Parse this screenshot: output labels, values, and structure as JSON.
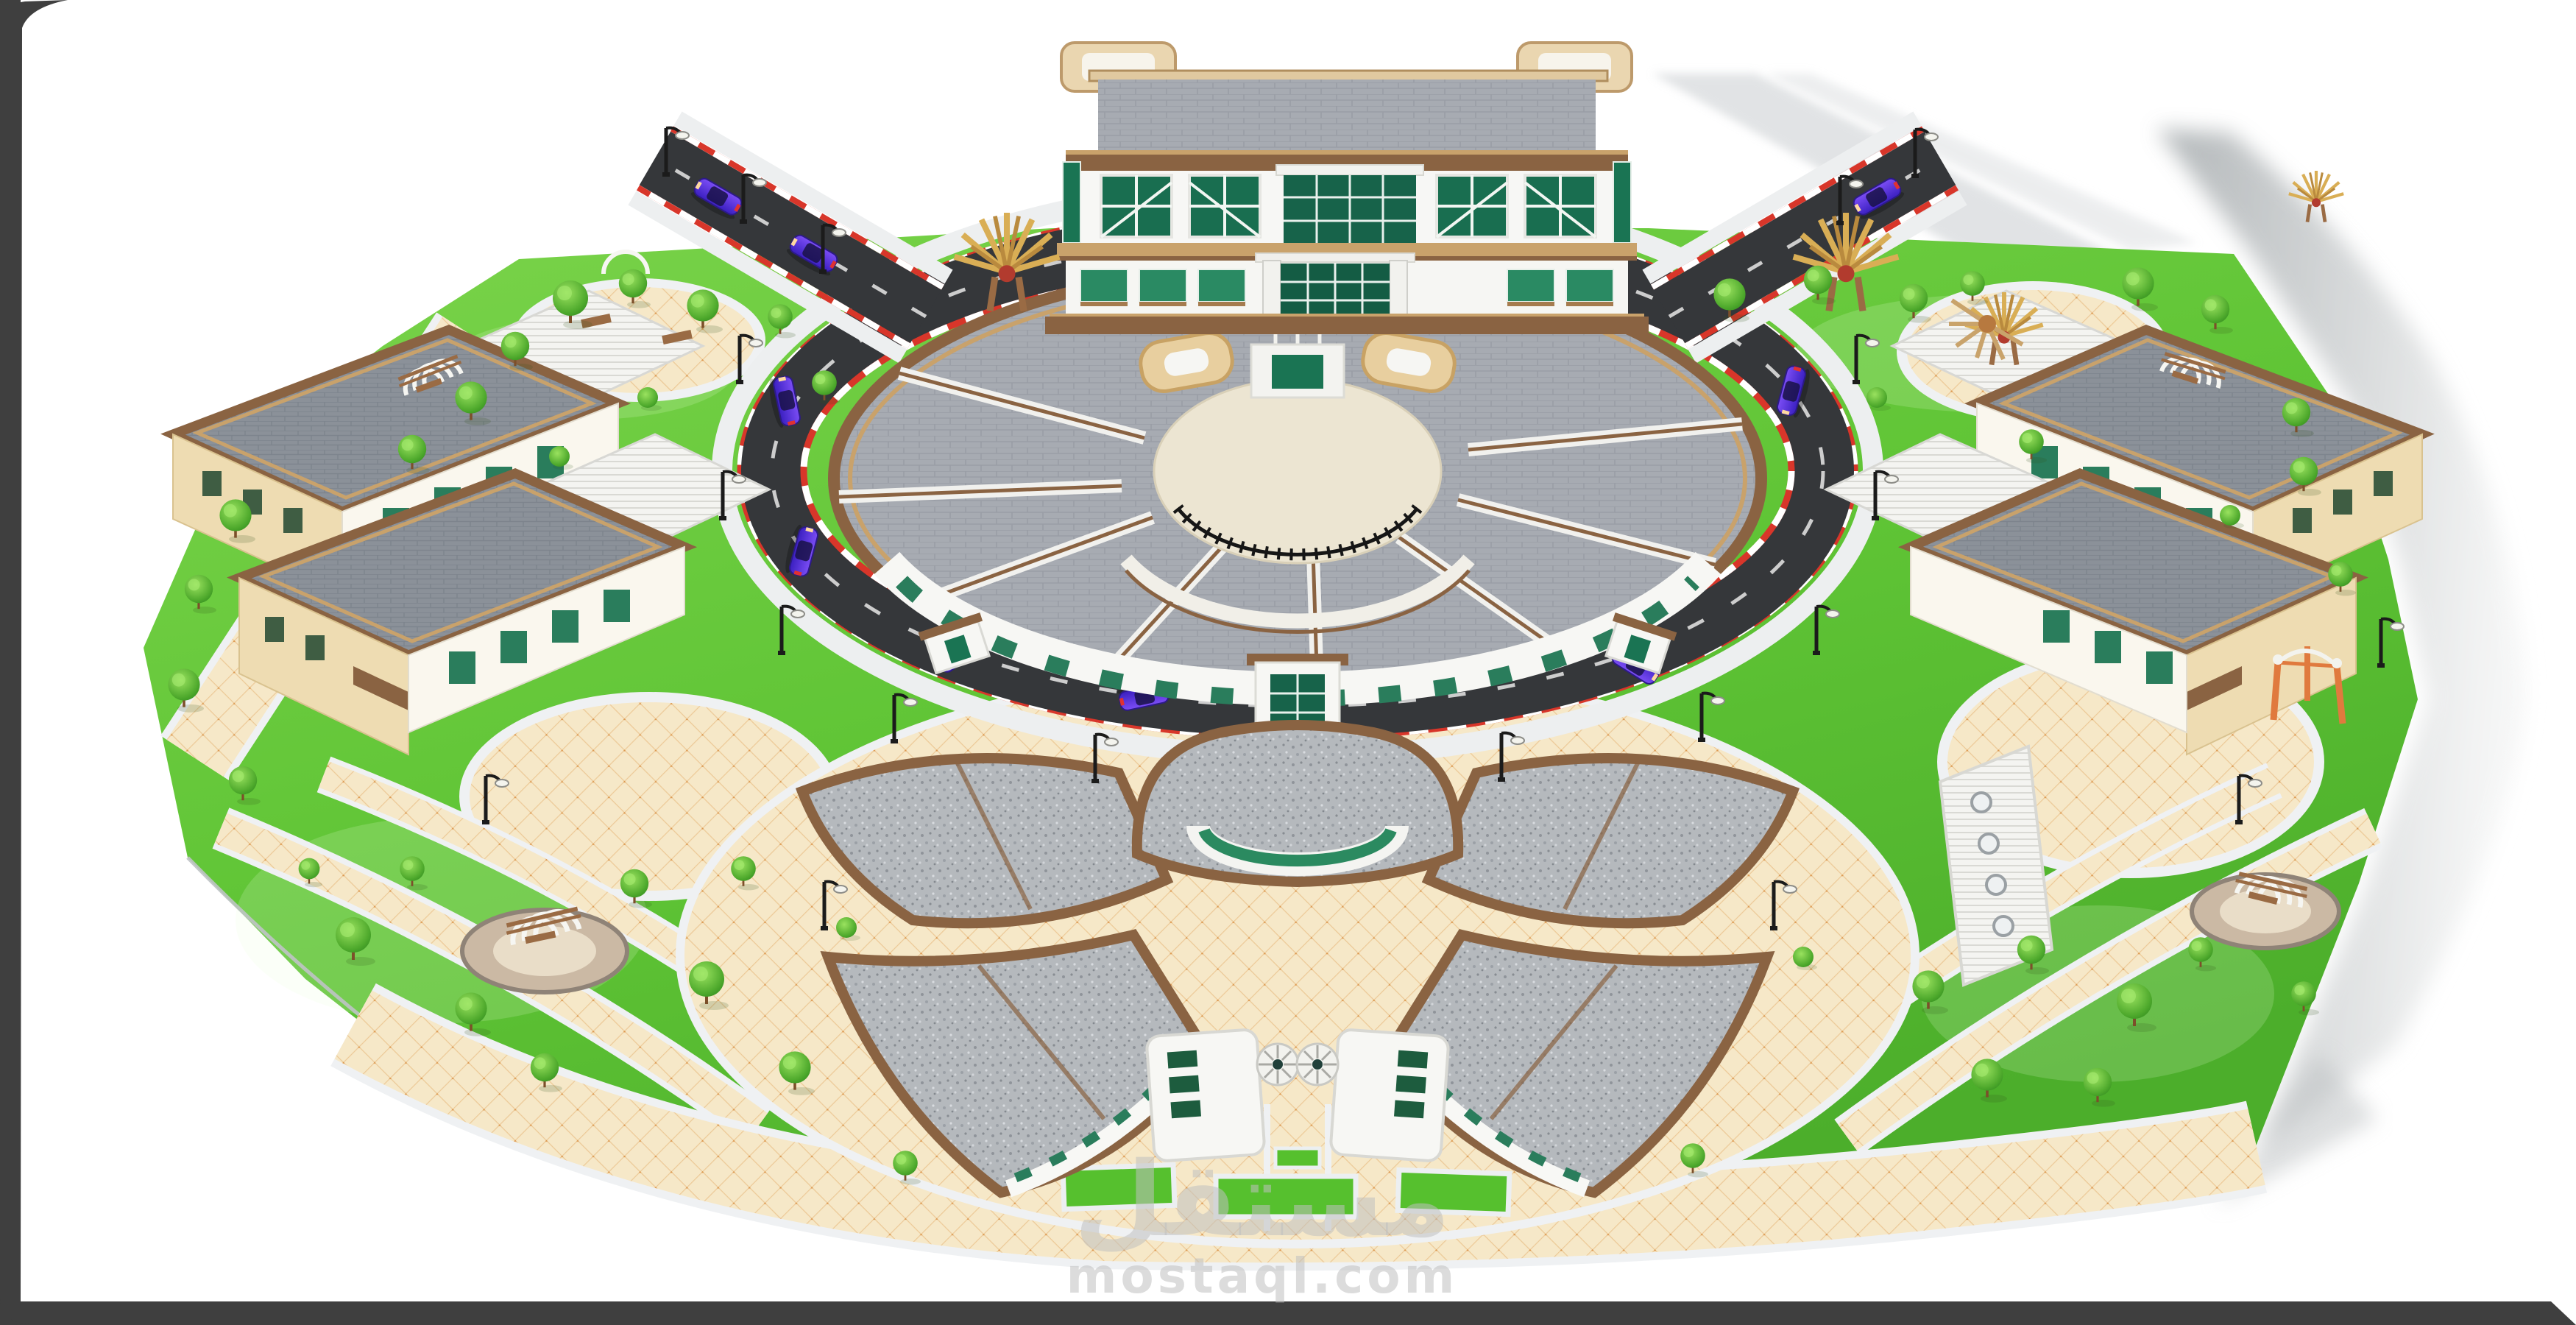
{
  "meta": {
    "image_type": "3d-architectural-rendering",
    "description": "Aerial isometric 3D render of a school / kindergarten campus master plan on a white background inside a dark rounded frame",
    "view": "high-angle aerial"
  },
  "watermark": {
    "logo_arabic": "مستقل",
    "domain_text": "mostaql.com",
    "color": "#d8d8d8"
  },
  "frame": {
    "color": "#3f3f3f"
  },
  "palette": {
    "background": "#ffffff",
    "grass": "#5fc435",
    "paving_cream": "#f6e8c8",
    "paving_grid": "#ecc997",
    "stone_border": "#eff1f3",
    "asphalt": "#35373a",
    "curb_red": "#d8362a",
    "roof_gray": "#a7abb2",
    "roof_slate": "#8b9199",
    "roof_speckle": "#b5b9bd",
    "trim_brown": "#8a6342",
    "trim_tan": "#c9a26b",
    "wall_beige": "#eedcb2",
    "wall_white": "#f7f7f5",
    "glass_green": "#17634a",
    "car_purple": "#5a35e8",
    "shadow_gray": "#aeb3b6"
  },
  "scene": {
    "buildings": [
      {
        "name": "main-administration-building",
        "position": "top-center",
        "features": "white facade, green curtain glass, tan cornices, twin tan roof towers"
      },
      {
        "name": "central-circular-classroom-building",
        "position": "center",
        "features": "large round gray tiled roof, brown trim, inner courtyard with black railing, twin tan gate emblems, flag poles"
      },
      {
        "name": "south-fan-classroom-complex",
        "position": "bottom-center",
        "features": "flower-shaped speckled gray roofs, brown ridges, spiral stairs, green window strips"
      },
      {
        "name": "west-block-a",
        "position": "left-upper"
      },
      {
        "name": "west-block-b",
        "position": "left-lower"
      },
      {
        "name": "east-block-a",
        "position": "right-upper"
      },
      {
        "name": "east-block-b",
        "position": "right-lower"
      }
    ],
    "roads": {
      "type": "ring road around central building with two diagonal spurs",
      "curb": "red-white striped",
      "markings": "white dashed center line"
    },
    "vehicles": {
      "count": 9,
      "color": "purple-blue sedans"
    },
    "landscape": {
      "lawns": "bright green grass fields",
      "paths": "cream diamond-tiled walkways with white stone borders",
      "trees": "approx. 40 round green trees and bushes",
      "features": [
        "pergola arches",
        "golden sun sculptures",
        "playground plazas",
        "street lamps",
        "hedge planters",
        "stone seating pads",
        "orange shade canopy"
      ]
    },
    "lighting": "sun from upper-left, long gray cast shadow to the right of the site"
  }
}
